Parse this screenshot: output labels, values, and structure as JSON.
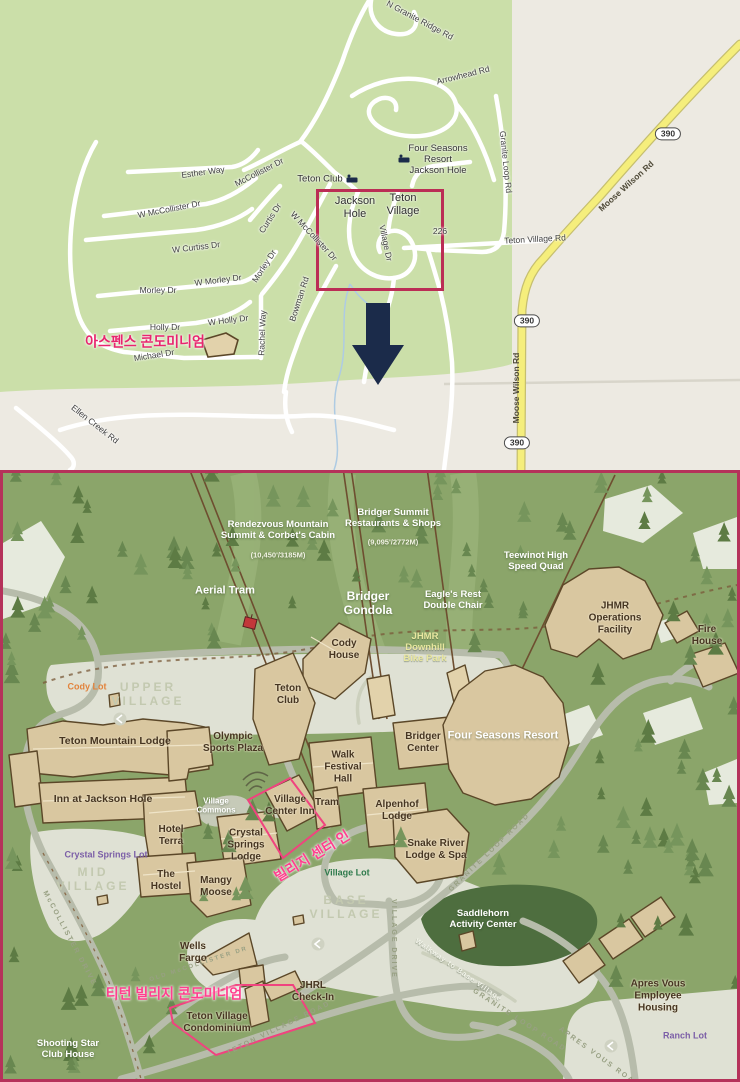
{
  "palette": {
    "top_green": "#cbdfa9",
    "top_beige": "#edeae2",
    "highway_yellow": "#f5ee7c",
    "highlight_pink_top": "#e8256e",
    "box_red": "#bb2d55",
    "arrow_navy": "#1b2b4a",
    "bottom_bg": "#8ba56a",
    "tree_dark": "#5d7b44",
    "building_tan": "#d9c7a0",
    "building_outline": "#5b4728",
    "lot_gray": "#dfe1d4",
    "road_gray": "#b7bcab",
    "label_pink_bottom": "#ff3f8e",
    "lot_purple": "#7b5ea7",
    "lot_green": "#2e7a4c",
    "lot_orange": "#e2833c",
    "lift_brown": "#6e4e30",
    "map_border": "#b5325a"
  },
  "top": {
    "labels": {
      "esther_way": "Esther Way",
      "mccollister_dr": "McCollister Dr",
      "w_mccollister_dr": "W McCollister Dr",
      "curtis_dr": "Curtis Dr",
      "w_curtiss_dr": "W Curtiss Dr",
      "morley_dr": "Morley Dr",
      "w_morley_dr": "W Morley Dr",
      "holly_dr": "Holly Dr",
      "w_holly_dr": "W Holly Dr",
      "rachel_way": "Rachel Way",
      "bowman_rd": "Bowman Rd",
      "michael_dr": "Michael Dr",
      "ellen_creek_rd": "Ellen Creek Rd",
      "village_dr": "Village Dr",
      "n_granite_ridge_rd": "N Granite Ridge Rd",
      "arrowhead_rd": "Arrowhead Rd",
      "granite_loop_rd": "Granite Loop Rd",
      "teton_village_rd": "Teton Village Rd",
      "moose_wilson_rd": "Moose Wilson Rd",
      "teton_club": "Teton Club",
      "four_seasons": "Four Seasons\nResort\nJackson Hole",
      "jackson_hole": "Jackson\nHole",
      "teton_village": "Teton\nVillage",
      "aspens_kr": "아스펜스 콘도미니엄",
      "r390": "390",
      "r226": "226"
    }
  },
  "bottom": {
    "labels": {
      "rendezvous": "Rendezvous Mountain\nSummit & Corbet's Cabin",
      "rendezvous_elev": "(10,450'/3185M)",
      "bridger_summit": "Bridger Summit\nRestaurants & Shops",
      "bridger_summit_elev": "(9,095'/2772M)",
      "teewinot": "Teewinot High\nSpeed Quad",
      "aerial_tram": "Aerial Tram",
      "bridger_gondola": "Bridger\nGondola",
      "eagles_rest": "Eagle's Rest\nDouble Chair",
      "jhmr_bike": "JHMR\nDownhill\nBike Park",
      "cody_house": "Cody\nHouse",
      "teton_club": "Teton\nClub",
      "walk_festival": "Walk\nFestival\nHall",
      "bridger_center": "Bridger\nCenter",
      "four_seasons": "Four Seasons Resort",
      "jhmr_ops": "JHMR\nOperations\nFacility",
      "fire_house": "Fire\nHouse",
      "cody_lot": "Cody Lot",
      "upper_village": "UPPER\nVILLAGE",
      "teton_mtn_lodge": "Teton Mountain Lodge",
      "olympic": "Olympic\nSports Plaza",
      "inn_jh": "Inn at Jackson Hole",
      "village_commons": "Village\nCommons",
      "hotel_terra": "Hotel\nTerra",
      "village_center_inn": "Village\nCenter Inn",
      "tram": "Tram",
      "alpenhof": "Alpenhof\nLodge",
      "crystal_lodge": "Crystal\nSprings\nLodge",
      "snake_river": "Snake River\nLodge & Spa",
      "crystal_lot": "Crystal Springs Lot",
      "mid_village": "MID\nVILLAGE",
      "hostel": "The\nHostel",
      "mangy_moose": "Mangy\nMoose",
      "village_lot": "Village Lot",
      "base_village": "BASE\nVILLAGE",
      "saddlehorn": "Saddlehorn\nActivity Center",
      "walkway": "Walkway to Base Village",
      "wells_fargo": "Wells\nFargo",
      "jhrl": "JHRL\nCheck-In",
      "tv_condo": "Teton Village\nCondominium",
      "shooting_star": "Shooting Star\nClub House",
      "apres_housing": "Apres Vous\nEmployee Housing",
      "ranch_lot": "Ranch Lot",
      "vci_kr": "빌리지 센터 인",
      "tvc_kr": "티턴 빌리지 콘도미니엄",
      "granite_loop_road": "GRANITE LOOP ROAD",
      "village_drive": "VILLAGE DRIVE",
      "teton_village_road": "TETON VILLAGE ROAD",
      "mccollister_drive": "McCOLLISTER DRIVE",
      "old_mccollister": "OLD McCOLLISTER DR",
      "apres_vous_road": "APRES VOUS ROAD"
    }
  }
}
